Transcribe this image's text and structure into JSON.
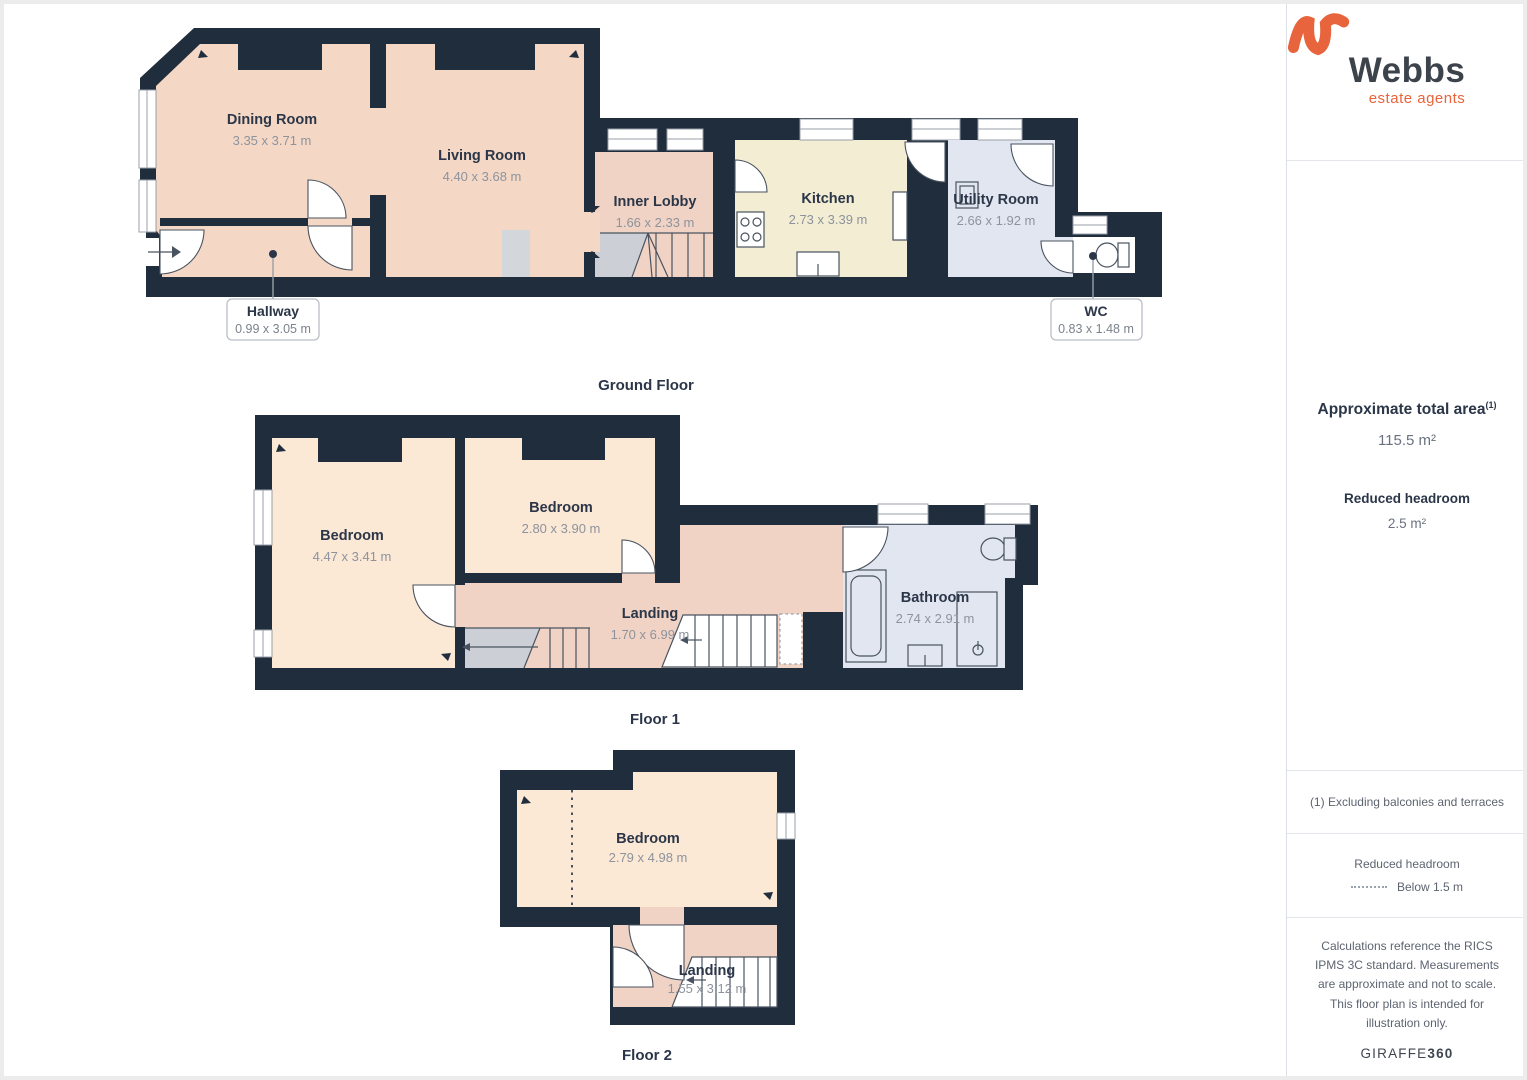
{
  "colors": {
    "wall": "#202d3c",
    "warm": "#f4d8c5",
    "circ": "#f0d3c4",
    "bed": "#fbe8d5",
    "kitchen": "#f2edd3",
    "wet": "#e2e6f0",
    "stair": "#ccd0d6",
    "hearth": "#d3d6db",
    "line": "#49535f",
    "frame": "#98a0a8",
    "textDark": "#2b3648",
    "textGrey": "#8d939d",
    "accent": "#e8643c",
    "divider": "#e3e6ea",
    "sidebarText": "#5d6470"
  },
  "brand": {
    "name": "Webbs",
    "tagline": "estate agents"
  },
  "floors": [
    {
      "caption": "Ground Floor",
      "rooms": [
        {
          "name": "Dining Room",
          "dims": "3.35 x 3.71 m"
        },
        {
          "name": "Living Room",
          "dims": "4.40 x 3.68 m"
        },
        {
          "name": "Inner Lobby",
          "dims": "1.66 x 2.33 m"
        },
        {
          "name": "Kitchen",
          "dims": "2.73 x 3.39 m"
        },
        {
          "name": "Utility Room",
          "dims": "2.66 x 1.92 m"
        },
        {
          "name": "Hallway",
          "dims": "0.99 x 3.05 m"
        },
        {
          "name": "WC",
          "dims": "0.83 x 1.48 m"
        }
      ]
    },
    {
      "caption": "Floor 1",
      "rooms": [
        {
          "name": "Bedroom",
          "dims": "4.47 x 3.41 m"
        },
        {
          "name": "Bedroom",
          "dims": "2.80 x 3.90 m"
        },
        {
          "name": "Landing",
          "dims": "1.70 x 6.99 m"
        },
        {
          "name": "Bathroom",
          "dims": "2.74 x 2.91 m"
        }
      ]
    },
    {
      "caption": "Floor 2",
      "rooms": [
        {
          "name": "Bedroom",
          "dims": "2.79 x 4.98 m"
        },
        {
          "name": "Landing",
          "dims": "1.55 x 3.12 m"
        }
      ]
    }
  ],
  "sidebar": {
    "area_heading": "Approximate total area",
    "area_sup": "(1)",
    "area_value": "115.5 m²",
    "headroom_heading": "Reduced headroom",
    "headroom_value": "2.5 m²",
    "footnote": "(1) Excluding balconies and terraces",
    "legend_title": "Reduced headroom",
    "legend_item": "Below 1.5 m",
    "disclaimer": "Calculations reference the RICS IPMS 3C standard. Measurements are approximate and not to scale. This floor plan is intended for illustration only.",
    "credit_main": "GIRAFFE",
    "credit_suffix": "360"
  }
}
